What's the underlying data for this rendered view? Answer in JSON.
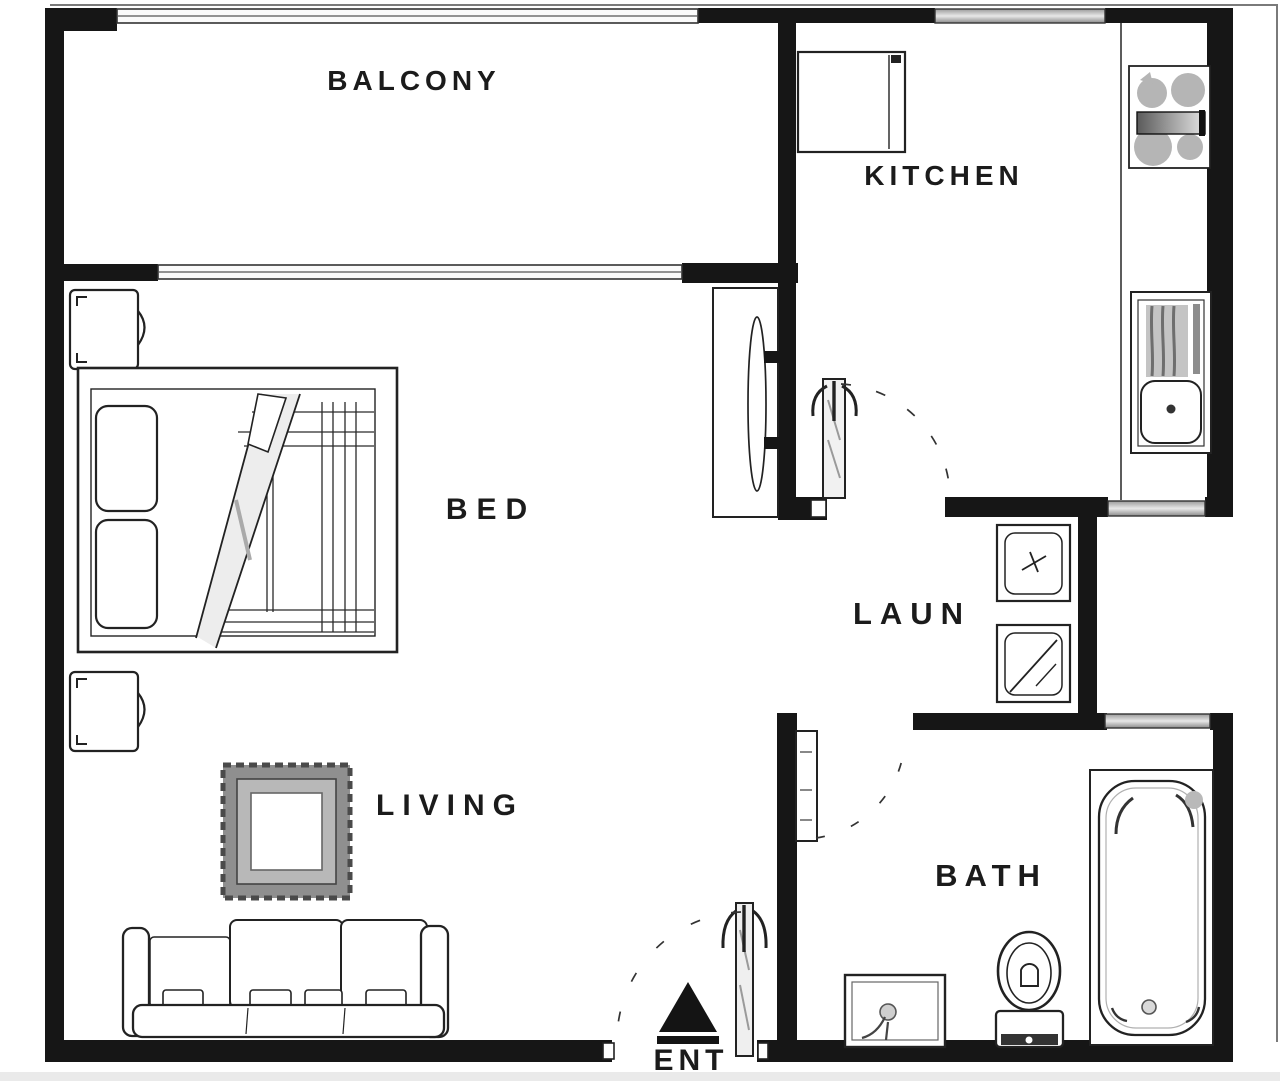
{
  "plan_title": "One-bedroom apartment floor plan",
  "colors": {
    "wall": "#161616",
    "line": "#2a2a2a",
    "window_fill": "#cdcdcd",
    "appliance_gray": "#b5b5b5",
    "rug_gray": "#8f8f8f",
    "text": "#1b1b1b",
    "background": "#ffffff"
  },
  "rooms": {
    "balcony": {
      "label": "BALCONY"
    },
    "kitchen": {
      "label": "KITCHEN"
    },
    "bed": {
      "label": "BED"
    },
    "laundry": {
      "label": "LAUN"
    },
    "living": {
      "label": "LIVING"
    },
    "bath": {
      "label": "BATH"
    },
    "entry": {
      "label": "ENT"
    }
  },
  "fixtures": {
    "kitchen": [
      "fridge",
      "cooktop",
      "counter",
      "kitchen-sink",
      "kitchen-door"
    ],
    "bedroom": [
      "nightstand-top",
      "double-bed",
      "nightstand-bottom",
      "wardrobe"
    ],
    "laundry": [
      "washer",
      "dryer"
    ],
    "living": [
      "rug",
      "sofa"
    ],
    "bath": [
      "bathtub",
      "toilet",
      "vanity-sink",
      "bath-door"
    ],
    "entry": [
      "entry-door",
      "entry-arrow"
    ]
  }
}
